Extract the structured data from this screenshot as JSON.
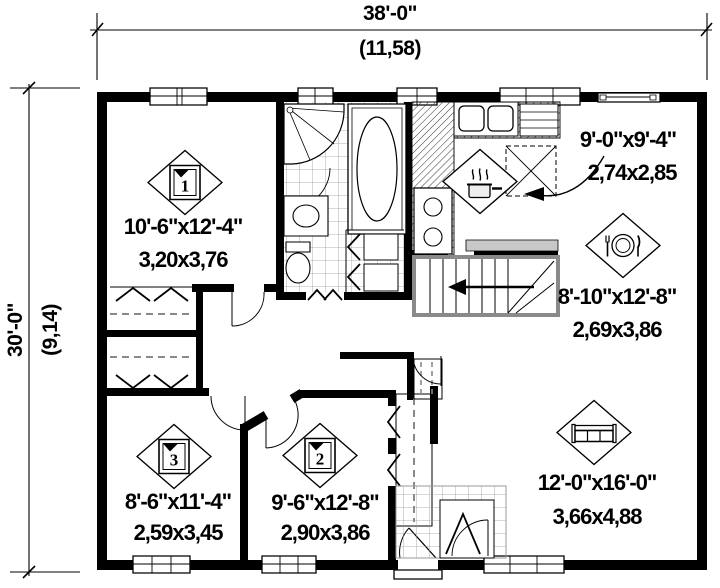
{
  "dimensions": {
    "width_ft": "38'-0\"",
    "width_m": "(11,58)",
    "height_ft": "30'-0\"",
    "height_m": "(9,14)"
  },
  "rooms": [
    {
      "name": "bedroom-1",
      "icon": "bed-icon",
      "badge": "1",
      "size_ft": "10'-6\"x12'-4\"",
      "size_m": "3,20x3,76"
    },
    {
      "name": "kitchen",
      "icon": "cooking-pot-icon",
      "size_ft": "9'-0\"x9'-4\"",
      "size_m": "2,74x2,85"
    },
    {
      "name": "dining-room",
      "icon": "dining-place-setting-icon",
      "size_ft": "8'-10\"x12'-8\"",
      "size_m": "2,69x3,86"
    },
    {
      "name": "bedroom-3",
      "icon": "bed-icon",
      "badge": "3",
      "size_ft": "8'-6\"x11'-4\"",
      "size_m": "2,59x3,45"
    },
    {
      "name": "bedroom-2",
      "icon": "bed-icon",
      "badge": "2",
      "size_ft": "9'-6\"x12'-8\"",
      "size_m": "2,90x3,86"
    },
    {
      "name": "living-room",
      "icon": "sofa-icon",
      "size_ft": "12'-0\"x16'-0\"",
      "size_m": "3,66x4,88"
    }
  ],
  "colors": {
    "wall": "#000000",
    "background": "#ffffff",
    "tile": "#9a9a9a",
    "stair_trim": "#8a8a8a"
  }
}
